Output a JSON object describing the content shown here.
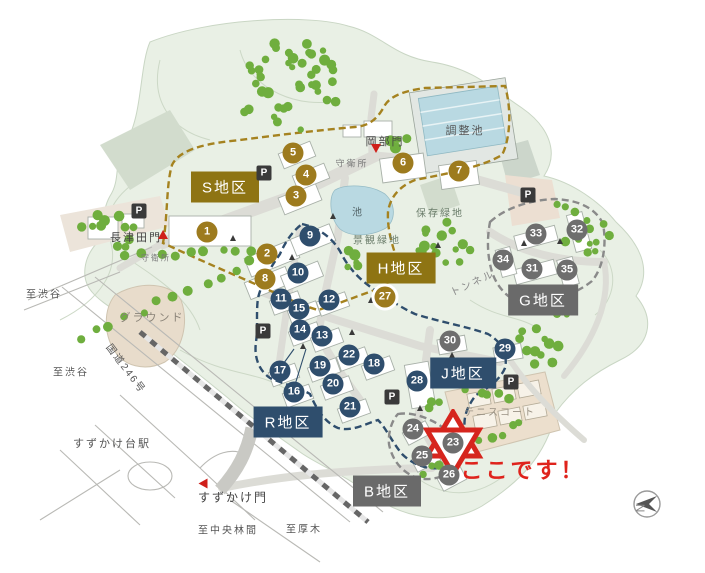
{
  "page": {
    "kind": "campus-area-map",
    "language": "ja"
  },
  "colors": {
    "district_gold": "#8e7413",
    "district_blue": "#2f4e6d",
    "district_gray": "#6a6a6a",
    "marker_gold": "#9d7b1e",
    "marker_blue": "#2f4e6d",
    "marker_gray": "#6e6e6e",
    "highlight_red": "#df231c",
    "tree_green": "#6fae3e",
    "terrain_green": "#e9f0e5",
    "water_blue": "#b9d9e2",
    "ground_beige": "#e8dccb"
  },
  "districts": [
    {
      "label": "S地区",
      "theme": "gold",
      "x": 225,
      "y": 187
    },
    {
      "label": "H地区",
      "theme": "gold",
      "x": 401,
      "y": 268
    },
    {
      "label": "G地区",
      "theme": "gray",
      "x": 543,
      "y": 300
    },
    {
      "label": "J地区",
      "theme": "blue",
      "x": 463,
      "y": 373
    },
    {
      "label": "R地区",
      "theme": "blue",
      "x": 288,
      "y": 422
    },
    {
      "label": "B地区",
      "theme": "gray",
      "x": 387,
      "y": 491
    }
  ],
  "markers": [
    {
      "n": "1",
      "x": 207,
      "y": 232,
      "color": "gold"
    },
    {
      "n": "2",
      "x": 267,
      "y": 254,
      "color": "gold"
    },
    {
      "n": "3",
      "x": 296,
      "y": 196,
      "color": "gold"
    },
    {
      "n": "4",
      "x": 306,
      "y": 175,
      "color": "gold"
    },
    {
      "n": "5",
      "x": 293,
      "y": 153,
      "color": "gold"
    },
    {
      "n": "6",
      "x": 403,
      "y": 163,
      "color": "gold"
    },
    {
      "n": "7",
      "x": 459,
      "y": 171,
      "color": "gold"
    },
    {
      "n": "8",
      "x": 265,
      "y": 279,
      "color": "gold"
    },
    {
      "n": "9",
      "x": 310,
      "y": 236,
      "color": "blue"
    },
    {
      "n": "10",
      "x": 298,
      "y": 273,
      "color": "blue"
    },
    {
      "n": "11",
      "x": 281,
      "y": 299,
      "color": "blue"
    },
    {
      "n": "12",
      "x": 329,
      "y": 300,
      "color": "blue"
    },
    {
      "n": "13",
      "x": 322,
      "y": 336,
      "color": "blue"
    },
    {
      "n": "14",
      "x": 300,
      "y": 330,
      "color": "blue"
    },
    {
      "n": "15",
      "x": 299,
      "y": 309,
      "color": "blue"
    },
    {
      "n": "16",
      "x": 294,
      "y": 392,
      "color": "blue"
    },
    {
      "n": "17",
      "x": 280,
      "y": 371,
      "color": "blue"
    },
    {
      "n": "18",
      "x": 374,
      "y": 364,
      "color": "blue"
    },
    {
      "n": "19",
      "x": 320,
      "y": 366,
      "color": "blue"
    },
    {
      "n": "20",
      "x": 333,
      "y": 384,
      "color": "blue"
    },
    {
      "n": "21",
      "x": 350,
      "y": 407,
      "color": "blue"
    },
    {
      "n": "22",
      "x": 349,
      "y": 355,
      "color": "blue"
    },
    {
      "n": "23",
      "x": 453,
      "y": 443,
      "color": "gray",
      "starred": true
    },
    {
      "n": "24",
      "x": 413,
      "y": 429,
      "color": "gray"
    },
    {
      "n": "25",
      "x": 422,
      "y": 456,
      "color": "gray"
    },
    {
      "n": "26",
      "x": 449,
      "y": 475,
      "color": "gray"
    },
    {
      "n": "27",
      "x": 385,
      "y": 297,
      "color": "gold",
      "ring": true
    },
    {
      "n": "28",
      "x": 417,
      "y": 381,
      "color": "blue"
    },
    {
      "n": "29",
      "x": 505,
      "y": 349,
      "color": "blue"
    },
    {
      "n": "30",
      "x": 450,
      "y": 341,
      "color": "gray"
    },
    {
      "n": "31",
      "x": 532,
      "y": 269,
      "color": "gray"
    },
    {
      "n": "32",
      "x": 577,
      "y": 230,
      "color": "gray"
    },
    {
      "n": "33",
      "x": 536,
      "y": 234,
      "color": "gray"
    },
    {
      "n": "34",
      "x": 503,
      "y": 260,
      "color": "gray"
    },
    {
      "n": "35",
      "x": 567,
      "y": 270,
      "color": "gray"
    }
  ],
  "parking": [
    {
      "label": "P",
      "x": 264,
      "y": 173
    },
    {
      "label": "P",
      "x": 139,
      "y": 211
    },
    {
      "label": "P",
      "x": 528,
      "y": 195
    },
    {
      "label": "P",
      "x": 263,
      "y": 331
    },
    {
      "label": "P",
      "x": 392,
      "y": 397
    },
    {
      "label": "P",
      "x": 511,
      "y": 382
    }
  ],
  "gates": [
    {
      "name": "岡部門",
      "x": 385,
      "y": 141,
      "size": 11,
      "tri_x": 376,
      "tri_y": 148,
      "tri_rot": 0
    },
    {
      "name": "長津田門",
      "x": 136,
      "y": 237,
      "size": 11,
      "tri_x": 163,
      "tri_y": 234,
      "tri_rot": 180
    },
    {
      "name": "すずかけ門",
      "x": 233,
      "y": 497,
      "size": 12,
      "tri_x": 203,
      "tri_y": 483,
      "tri_rot": 90
    }
  ],
  "map_labels": [
    {
      "text": "調整池",
      "x": 465,
      "y": 130,
      "size": 11,
      "color": "#555"
    },
    {
      "text": "守衛所",
      "x": 352,
      "y": 163,
      "size": 9,
      "color": "#777"
    },
    {
      "text": "池",
      "x": 358,
      "y": 211,
      "size": 10,
      "color": "#55666a"
    },
    {
      "text": "保存緑地",
      "x": 440,
      "y": 212,
      "size": 10,
      "color": "#6b7d6b"
    },
    {
      "text": "景観緑地",
      "x": 377,
      "y": 239,
      "size": 10,
      "color": "#6b7d6b"
    },
    {
      "text": "トンネル",
      "x": 472,
      "y": 282,
      "size": 10,
      "color": "#8a8a8a",
      "rot": -25
    },
    {
      "text": "グラウンド",
      "x": 152,
      "y": 317,
      "size": 11,
      "color": "#8a8378"
    },
    {
      "text": "守衛所",
      "x": 156,
      "y": 258,
      "size": 8,
      "color": "#777"
    },
    {
      "text": "至渋谷",
      "x": 44,
      "y": 293,
      "size": 10,
      "color": "#555"
    },
    {
      "text": "至渋谷",
      "x": 71,
      "y": 371,
      "size": 10,
      "color": "#555"
    },
    {
      "text": "国道246号",
      "x": 127,
      "y": 368,
      "size": 10,
      "color": "#555",
      "rot": 53
    },
    {
      "text": "すずかけ台駅",
      "x": 112,
      "y": 443,
      "size": 11,
      "color": "#555"
    },
    {
      "text": "至中央林間",
      "x": 228,
      "y": 529,
      "size": 10,
      "color": "#555"
    },
    {
      "text": "至厚木",
      "x": 304,
      "y": 528,
      "size": 10,
      "color": "#555"
    },
    {
      "text": "テニスコート",
      "x": 500,
      "y": 411,
      "size": 10,
      "color": "#9a9284"
    }
  ],
  "callout": {
    "text": "ここです！",
    "x": 523,
    "y": 469
  },
  "compass": {
    "label": "N"
  }
}
